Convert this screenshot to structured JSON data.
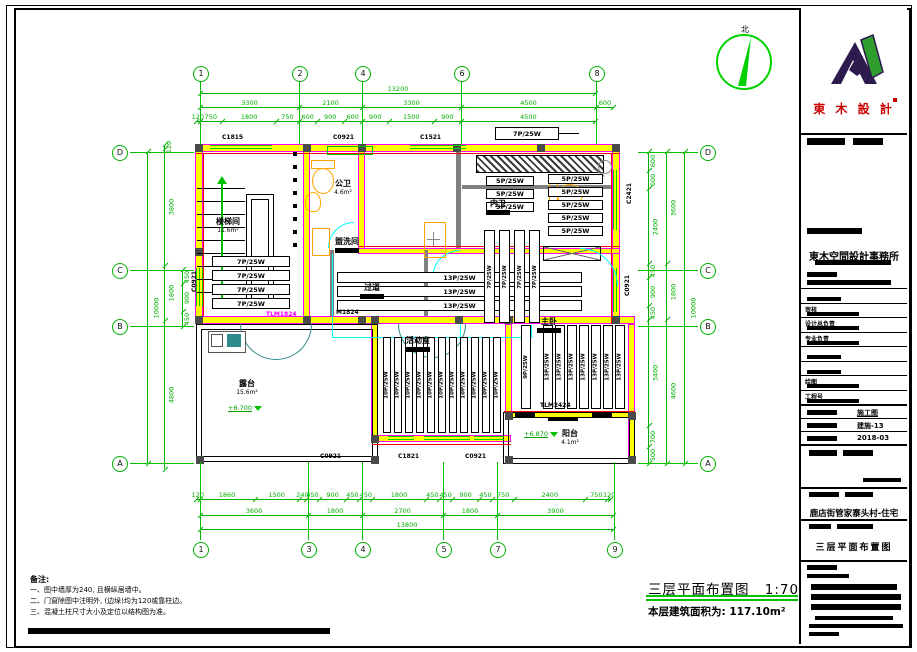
{
  "colors": {
    "grid_green": "#00c000",
    "wall_yellow": "#ffff00",
    "wall_magenta": "#ff00ff",
    "pipe_cyan": "#00ffff",
    "accent_red": "#ff0000",
    "fixture_orange": "#ffa500",
    "door_teal": "#2e8b8b",
    "brand_red": "#cc0000",
    "logo_purple": "#2d1b4e",
    "logo_green": "#2f9e2f"
  },
  "north": {
    "label": "北"
  },
  "brand": {
    "logo_name": "東 木 設 計",
    "firm_name": "東木空間設計事務所"
  },
  "titleblock": {
    "personnel_rows": [
      {
        "label": ""
      },
      {
        "label": "审核"
      },
      {
        "label": "设计总负责"
      },
      {
        "label": "专业负责"
      },
      {
        "label": ""
      },
      {
        "label": ""
      },
      {
        "label": "绘图"
      },
      {
        "label": "工程号"
      }
    ],
    "doc_rows": [
      {
        "value": "施工图"
      },
      {
        "value": "建施-13"
      },
      {
        "value": "2018-03"
      }
    ],
    "project_name": "鹿店街管家寨头村-住宅",
    "drawing_name": "三层平面布置图"
  },
  "caption": {
    "title": "三层平面布置图",
    "scale": "1:70",
    "area_note": "本层建筑面积为: 117.10m²"
  },
  "notes": {
    "heading": "备注:",
    "items": [
      "一、图中墙厚为240, 且横纵居墙中。",
      "二、门窗除图中注明外, (边垛)均为120或靠柱边。",
      "三、混凝土柱尺寸大小及定位以结构图为准。"
    ]
  },
  "axes": {
    "top": [
      "1",
      "2",
      "4",
      "6",
      "8"
    ],
    "bottom": [
      "1",
      "3",
      "4",
      "5",
      "7",
      "9"
    ],
    "left": [
      "D",
      "C",
      "B",
      "A"
    ],
    "right": [
      "D",
      "C",
      "B",
      "A"
    ]
  },
  "dims": {
    "top": [
      {
        "values": [
          13200
        ]
      },
      {
        "values": [
          3300,
          2100,
          3300,
          4500,
          600
        ]
      },
      {
        "values": [
          120,
          750,
          1800,
          750,
          600,
          900,
          600,
          900,
          1500,
          900,
          4500
        ]
      }
    ],
    "bottom": [
      {
        "values": [
          120,
          1860,
          1500,
          240,
          450,
          900,
          450,
          450,
          1800,
          450,
          450,
          900,
          450,
          750,
          2400,
          750,
          120
        ]
      },
      {
        "values": [
          3600,
          1800,
          2700,
          1800,
          3900
        ]
      },
      {
        "values": [
          13800
        ]
      }
    ],
    "left": [
      {
        "values": [
          450,
          900,
          450
        ]
      },
      {
        "values": [
          120,
          3800,
          1800,
          4800
        ]
      },
      {
        "values": [
          10000
        ]
      }
    ],
    "right": [
      {
        "values": [
          600,
          600,
          2400,
          450,
          900,
          450,
          3400,
          700,
          500
        ]
      },
      {
        "values": [
          3600,
          1800,
          4600
        ]
      },
      {
        "values": [
          10000
        ]
      }
    ]
  },
  "rooms": [
    {
      "name": "楼梯间",
      "area": "11.6m²",
      "redacted": false
    },
    {
      "name": "公卫",
      "area": "4.6m²",
      "redacted": false
    },
    {
      "name": "内卫",
      "area": "",
      "redacted": true
    },
    {
      "name": "盥洗间",
      "area": "",
      "redacted": true
    },
    {
      "name": "过道",
      "area": "",
      "redacted": true
    },
    {
      "name": "活动室",
      "area": "",
      "redacted": true
    },
    {
      "name": "主卧",
      "area": "",
      "redacted": true
    },
    {
      "name": "露台",
      "area": "15.6m²",
      "redacted": false
    },
    {
      "name": "阳台",
      "area": "4.1m²",
      "redacted": false
    }
  ],
  "elevations": [
    {
      "text": "+6.700"
    },
    {
      "text": "+6.870"
    }
  ],
  "stair": {
    "note": "下21步"
  },
  "wall_tag": {
    "label": "7P/25W"
  },
  "radiator_groups": [
    {
      "label": "7P/25W",
      "count": 4,
      "orient": "h"
    },
    {
      "label": "13P/25W",
      "count": 3,
      "orient": "h"
    },
    {
      "label": "5P/25W",
      "count": 3,
      "orient": "h"
    },
    {
      "label": "5P/25W",
      "count": 5,
      "orient": "h"
    },
    {
      "label": "7P/25W",
      "count": 4,
      "orient": "v"
    },
    {
      "label": "10P/25W",
      "count": 11,
      "orient": "v"
    },
    {
      "label": "13P/25W",
      "count": 7,
      "orient": "v"
    },
    {
      "label": "9P/25W",
      "count": 1,
      "orient": "v"
    }
  ],
  "opening_codes": [
    {
      "text": "C1815"
    },
    {
      "text": "C0921"
    },
    {
      "text": "C1521"
    },
    {
      "text": "C0921"
    },
    {
      "text": "C1821"
    },
    {
      "text": "C0921"
    },
    {
      "text": "C0921"
    },
    {
      "text": "C2421"
    },
    {
      "text": "C0921"
    },
    {
      "text": "TLM2424"
    },
    {
      "text": "M1824"
    },
    {
      "text": "TLM1824"
    }
  ]
}
